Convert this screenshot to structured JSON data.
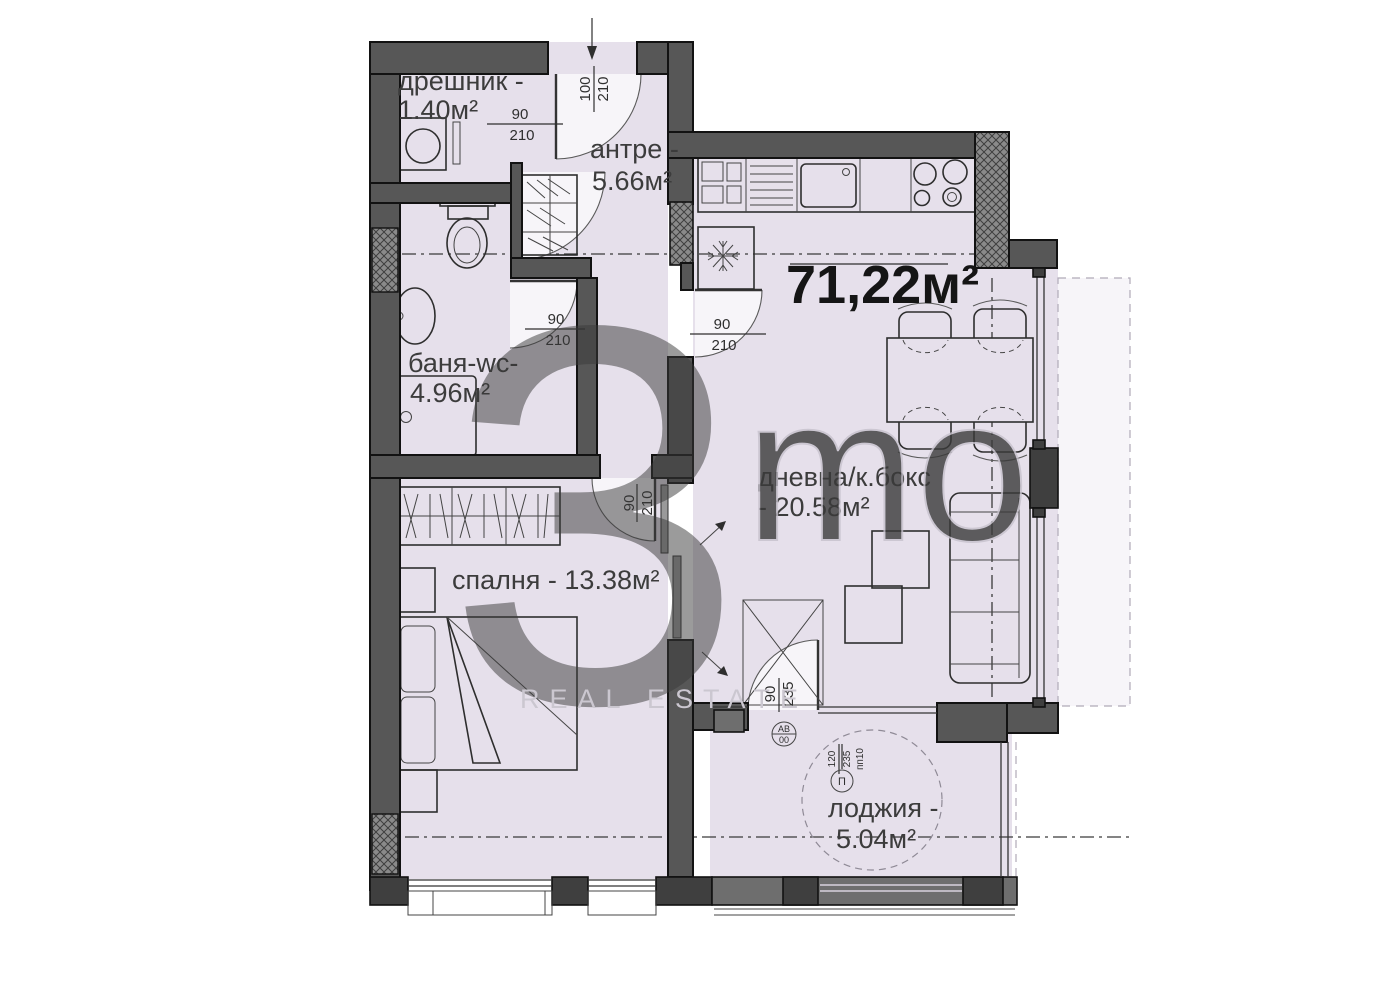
{
  "total_area": "71,22м²",
  "rooms": {
    "closet": {
      "name": "дрешник -",
      "area": "1.40м²"
    },
    "antre": {
      "name": "антре -",
      "area": "5.66м²"
    },
    "bath": {
      "name": "баня-wc-",
      "area": "4.96м²"
    },
    "bedroom": {
      "name": "спалня - 13.38м²"
    },
    "living": {
      "name": "дневна/к.бокс",
      "area": "- 20.58м²"
    },
    "loggia": {
      "name": "лоджия -",
      "area": "5.04м²"
    }
  },
  "dimensions": {
    "closet_door": {
      "w": "90",
      "h": "210"
    },
    "entrance_door": {
      "w": "100",
      "h": "210"
    },
    "bath_door": {
      "w": "90",
      "h": "210"
    },
    "living_door": {
      "w": "90",
      "h": "210"
    },
    "bedroom_door": {
      "w": "90",
      "h": "210"
    },
    "loggia_door": {
      "w": "90",
      "h": "235"
    },
    "loggia_window": {
      "w": "120",
      "h": "235",
      "note": "пп10"
    }
  },
  "markers": {
    "axis_circle_line1": "АВ",
    "axis_circle_line2": "00",
    "panel_circle": "П",
    "vent_left": "вб",
    "vent_right": "К"
  },
  "watermark": {
    "digit": "3",
    "letters": "mo",
    "caption": "REAL ESTATE"
  },
  "colors": {
    "floor": "#e6e0eb",
    "wall": "#575757",
    "outer_strip": "#f7f5f9"
  }
}
